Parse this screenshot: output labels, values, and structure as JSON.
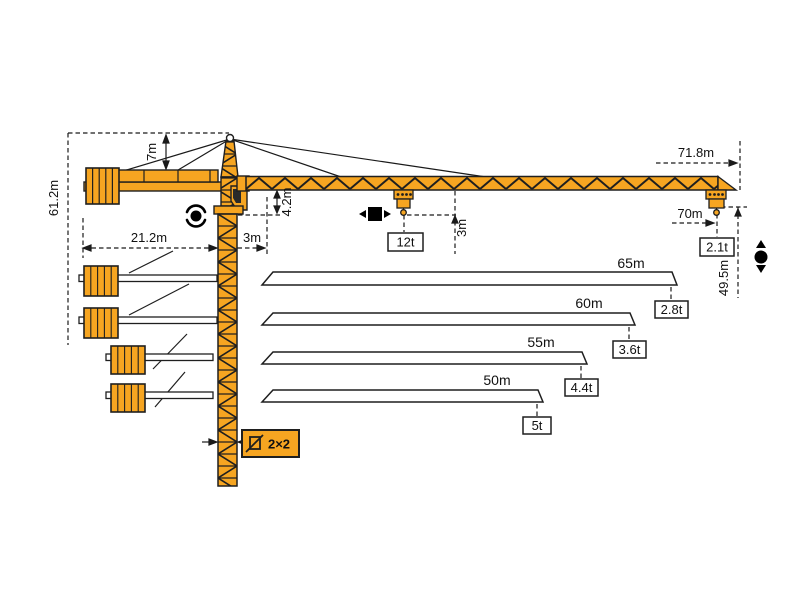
{
  "diagram": {
    "type": "tower-crane-load-chart",
    "colors": {
      "crane": "#F6A521",
      "outline": "#1F1F1F",
      "white": "#FFFFFF"
    },
    "dims": {
      "total_height": "61.2m",
      "head_height": "7m",
      "counterjib_radius": "21.2m",
      "rear_clearance": "3m",
      "jib_foot_offset": "4.2m",
      "hook_clearance": "3m",
      "max_radius": "71.8m",
      "tip_load_radius": "70m",
      "hook_height": "49.5m",
      "mast_section": "2×2"
    },
    "loads": {
      "max_capacity": "12t",
      "tip_capacity": "2.1t"
    },
    "icons": [
      "slewing-icon",
      "trolley-travel-icon",
      "hoisting-icon"
    ],
    "jib_options": [
      {
        "length": "65m",
        "tip_capacity": "2.8t"
      },
      {
        "length": "60m",
        "tip_capacity": "3.6t"
      },
      {
        "length": "55m",
        "tip_capacity": "4.4t"
      },
      {
        "length": "50m",
        "tip_capacity": "5t"
      }
    ]
  }
}
